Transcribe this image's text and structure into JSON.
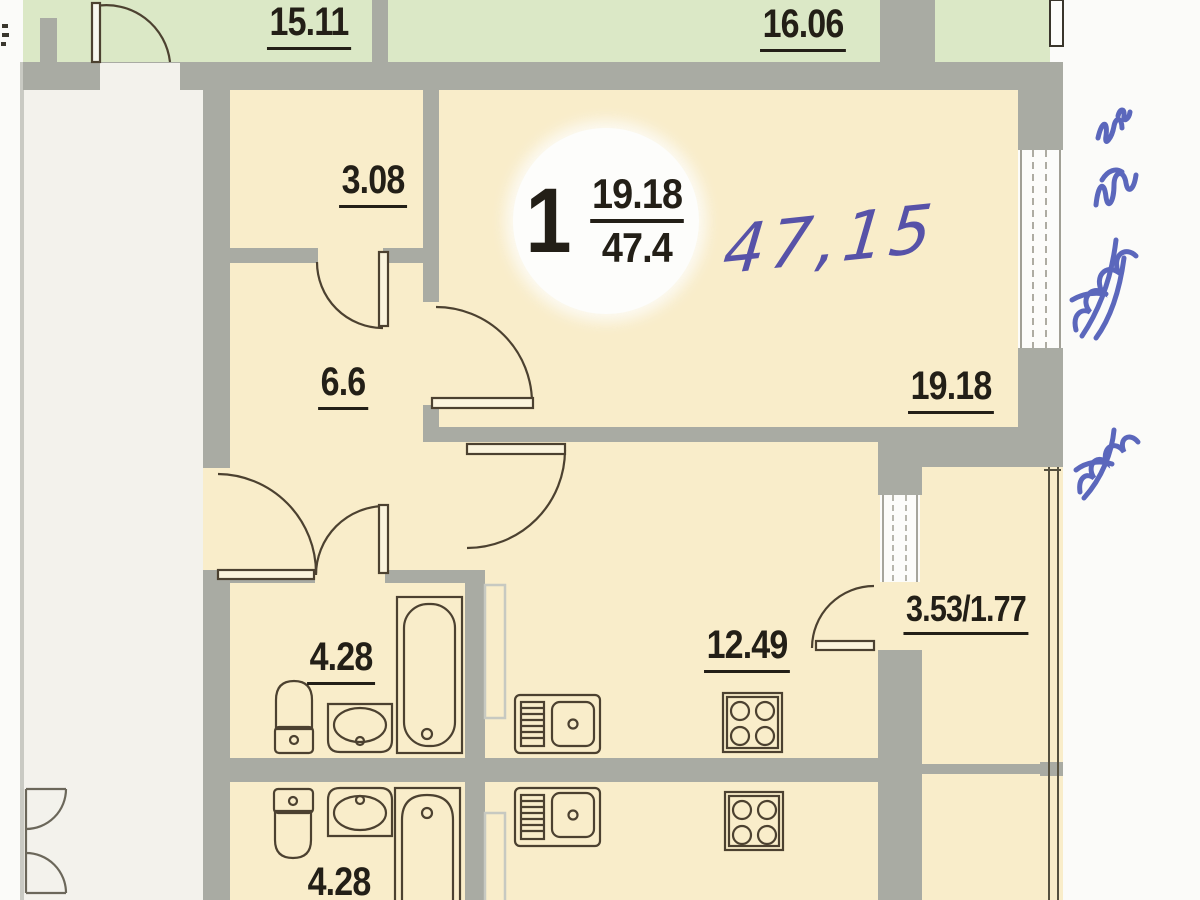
{
  "title": "apartment-floor-plan-scan",
  "colors": {
    "page": "#fbfbf9",
    "corridor": "#f3f2ec",
    "green": "#dbe8c6",
    "cream": "#f9edca",
    "wall": "#a9aba3",
    "text": "#231f17",
    "line-dark": "#4c4130",
    "duct": "#c7c9c1",
    "ink-blue": "#4553b4",
    "ink-violet": "#5752a8"
  },
  "neighbor_rooms": {
    "room_a": "15.11",
    "room_b": "16.06"
  },
  "apartment": {
    "badge": {
      "room_count": "1",
      "living_area": "19.18",
      "total_area": "47.4"
    },
    "handwritten_note": "47,15",
    "rooms": {
      "closet": "3.08",
      "hallway": "6.6",
      "living": "19.18",
      "bathroom": "4.28",
      "kitchen": "12.49",
      "balcony": "3.53/1.77"
    }
  },
  "mirrored_unit": {
    "bathroom": "4.28"
  },
  "icons": [
    "toilet-icon",
    "wash-sink-icon",
    "bathtub-icon",
    "kitchen-sink-icon",
    "stove-icon",
    "door-arc-icon",
    "window-icon",
    "ink-scribble-icon"
  ]
}
